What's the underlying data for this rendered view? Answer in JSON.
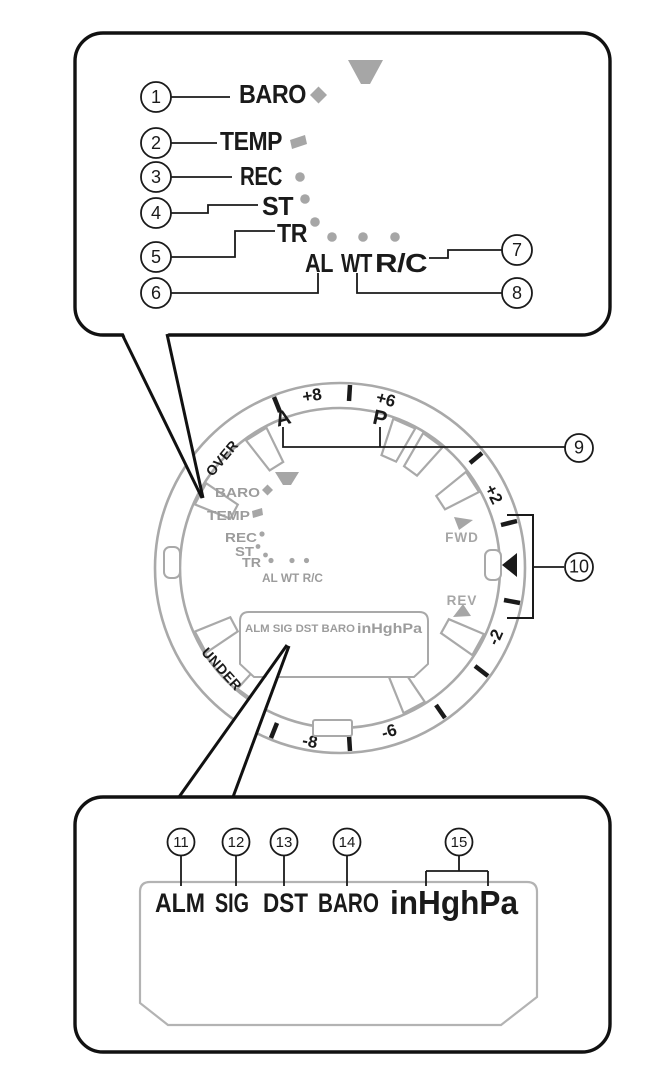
{
  "colors": {
    "black": "#1a1a1a",
    "dial_gray": "#a9a9a9",
    "gray_shape": "#a6a6a6",
    "gray_text": "#9c9c9c"
  },
  "top_panel": {
    "callouts": {
      "n1": "1",
      "n2": "2",
      "n3": "3",
      "n4": "4",
      "n5": "5",
      "n6": "6",
      "n7": "7",
      "n8": "8"
    },
    "indicators": {
      "baro": "BARO",
      "temp": "TEMP",
      "rec": "REC",
      "st": "ST",
      "tr": "TR",
      "al": "AL",
      "wt": "WT",
      "rc": "R/C"
    }
  },
  "dial": {
    "callouts": {
      "n9": "9",
      "n10": "10"
    },
    "letters": {
      "a": "A",
      "p": "P"
    },
    "scale": {
      "plus8": "+8",
      "plus6": "+6",
      "plus2": "+2",
      "minus2": "-2",
      "minus6": "-6",
      "minus8": "-8"
    },
    "arc_labels": {
      "over": "OVER",
      "under": "UNDER"
    },
    "direction_labels": {
      "fwd": "FWD",
      "rev": "REV"
    },
    "mini_indicators": {
      "baro": "BARO",
      "temp": "TEMP",
      "rec": "REC",
      "st": "ST",
      "tr": "TR",
      "al_wt_rc": "AL WT R/C"
    },
    "lcd": {
      "row": "ALM SIG DST BARO",
      "units": "inHghPa"
    }
  },
  "bottom_panel": {
    "callouts": {
      "n11": "11",
      "n12": "12",
      "n13": "13",
      "n14": "14",
      "n15": "15"
    },
    "labels": {
      "alm": "ALM",
      "sig": "SIG",
      "dst": "DST",
      "baro": "BARO",
      "units": "inHghPa"
    }
  }
}
